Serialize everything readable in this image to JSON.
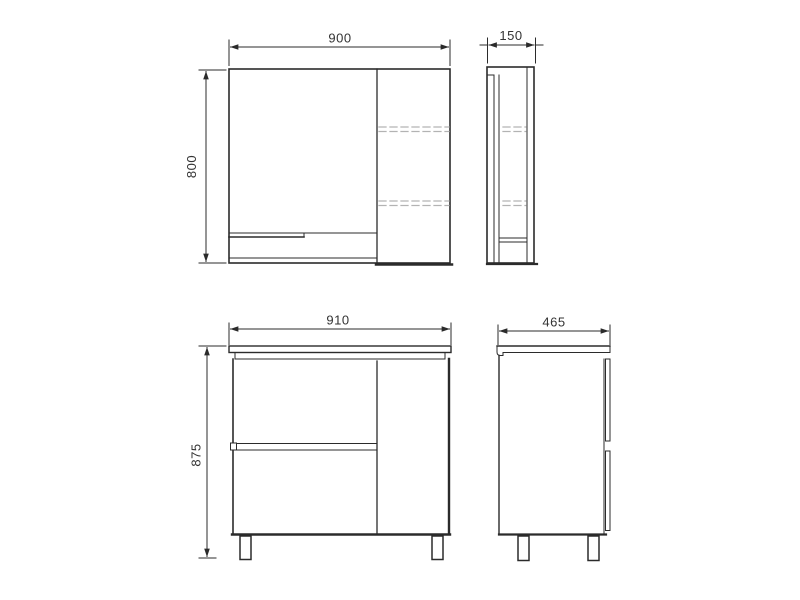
{
  "drawing": {
    "line_color": "#2b2b2b",
    "dashed_line_color": "#b3b3b3",
    "text_color": "#333333",
    "background_color": "#ffffff",
    "views": {
      "mirror_front": {
        "width": "900",
        "height": "800"
      },
      "mirror_side": {
        "depth": "150"
      },
      "vanity_front": {
        "width": "910",
        "height": "875"
      },
      "vanity_side": {
        "depth": "465"
      }
    }
  }
}
